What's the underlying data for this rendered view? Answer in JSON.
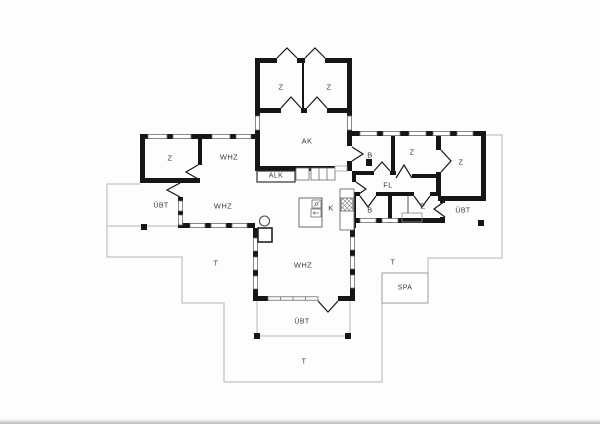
{
  "drawing": {
    "type": "architectural-floor-plan",
    "colors": {
      "wall": "#161616",
      "window_frame": "#6b6b6b",
      "terrace_line": "#b5b5b5",
      "background": "#fdfdfd",
      "label": "#3a3a3a"
    }
  },
  "labels": [
    {
      "id": "bedroom-top-left",
      "text": "Z"
    },
    {
      "id": "bedroom-top-right",
      "text": "Z"
    },
    {
      "id": "work-room",
      "text": "AK"
    },
    {
      "id": "alcove-closet",
      "text": "ALK"
    },
    {
      "id": "bedroom-west",
      "text": "Z"
    },
    {
      "id": "living-room-north",
      "text": "WHZ"
    },
    {
      "id": "covered-terrace-west",
      "text": "ÜBT"
    },
    {
      "id": "living-room-middle",
      "text": "WHZ"
    },
    {
      "id": "kitchen",
      "text": "K"
    },
    {
      "id": "bath-north",
      "text": "B"
    },
    {
      "id": "bedroom-mid-east",
      "text": "Z"
    },
    {
      "id": "bedroom-far-east",
      "text": "Z"
    },
    {
      "id": "hallway",
      "text": "FL"
    },
    {
      "id": "bath-south",
      "text": "B"
    },
    {
      "id": "entry",
      "text": "E"
    },
    {
      "id": "covered-terrace-east",
      "text": "ÜBT"
    },
    {
      "id": "living-room-south",
      "text": "WHZ"
    },
    {
      "id": "covered-terrace-south",
      "text": "ÜBT"
    },
    {
      "id": "spa",
      "text": "SPA"
    },
    {
      "id": "terrace-west",
      "text": "T"
    },
    {
      "id": "terrace-east",
      "text": "T"
    },
    {
      "id": "terrace-south",
      "text": "T"
    }
  ]
}
